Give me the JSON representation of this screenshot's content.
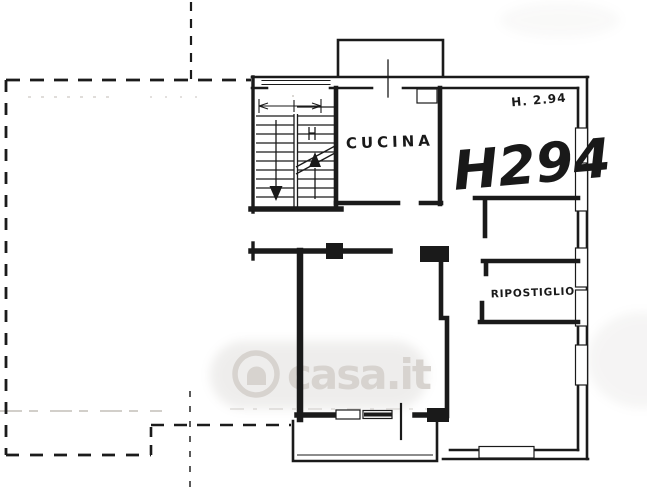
{
  "colors": {
    "ink": "#1a1a1a",
    "paper": "#ffffff",
    "watermark": "#d7d3cf"
  },
  "labels": {
    "kitchen": "CUCINA",
    "storage": "RIPOSTIGLIO",
    "height_note": "H. 2.94",
    "height_scrawl": "H294"
  },
  "watermark": {
    "text": "casa.it"
  }
}
